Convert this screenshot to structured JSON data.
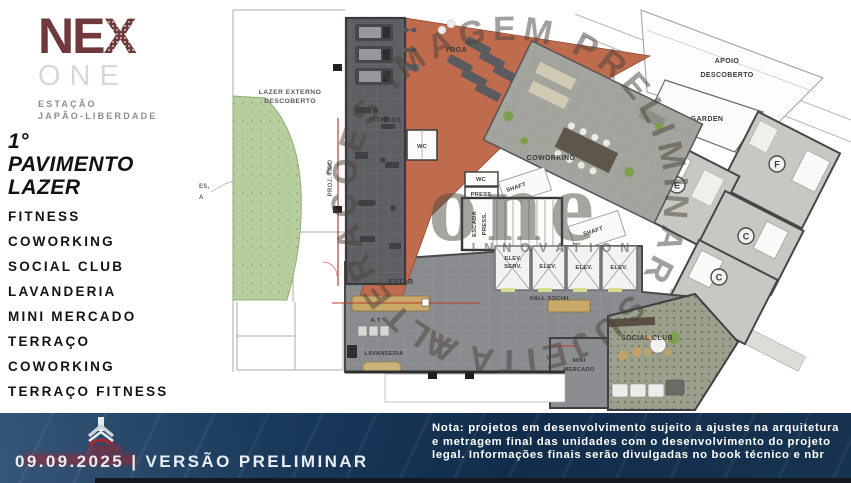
{
  "brand": {
    "nex_ne": "NE",
    "nex_x": "X",
    "one": "ONE",
    "station_line1": "ESTAÇÃO",
    "station_line2": "JAPÃO-LIBERDADE"
  },
  "sidebar": {
    "title_line1": "1°",
    "title_line2": "PAVIMENTO",
    "title_line3": "LAZER",
    "items": [
      "FITNESS",
      "COWORKING",
      "SOCIAL CLUB",
      "LAVANDERIA",
      "MINI MERCADO",
      "TERRAÇO",
      "COWORKING",
      "TERRAÇO FITNESS"
    ]
  },
  "plan": {
    "lazer_externo_1": "LAZER EXTERNO",
    "lazer_externo_2": "DESCOBERTO",
    "proj_tipo": "PROJ. TIPO",
    "fitness": "FITNESS",
    "wc": "WC",
    "press": "PRESS",
    "yoga": "YOGA",
    "coworking": "COWORKING",
    "apoio_1": "APOIO",
    "apoio_2": "DESCOBERTO",
    "garden": "GARDEN",
    "shaft": "SHAFT",
    "escada_1": "ESCADA",
    "escada_2": "PRESS.",
    "elev_serv_1": "ELEV.",
    "elev_serv_2": "SERV.",
    "elev": "ELEV.",
    "hall_social": "HALL SOCIAL",
    "estar": "ESTAR",
    "at": "A.T.",
    "lavanderia": "LAVANDERIA",
    "mini_1": "MINI",
    "mini_2": "MERCADO",
    "social_club": "SOCIAL CLUB",
    "unit_e": "E",
    "unit_f": "F",
    "unit_c": "C",
    "edge_note_1": "ES,",
    "edge_note_2": "A"
  },
  "watermark": {
    "circle_text": "ALTERAÇÕES IMAGEM PRELIMINAR SUJEITA A",
    "logo_main": "one",
    "logo_sub": "INNOVATION"
  },
  "footer": {
    "date": "09.09.2025",
    "separator": "|",
    "version": "VERSÃO PRELIMINAR",
    "note": "Nota: projetos em desenvolvimento sujeito a ajustes na arquitetura e metragem final das unidades com o desenvolvimento do projeto legal. Informações finais serão divulgadas no book técnico e nbr"
  },
  "colors": {
    "brand_maroon": "#703a3c",
    "footer_navy": "#16334f",
    "plan_orange": "#bf6b4e",
    "plan_dark_gray": "#5d5f63",
    "plan_gray": "#898b8f",
    "garden_green": "#b7cf9e",
    "section_red": "#b03030",
    "watermark_brown": "#4a423b"
  }
}
